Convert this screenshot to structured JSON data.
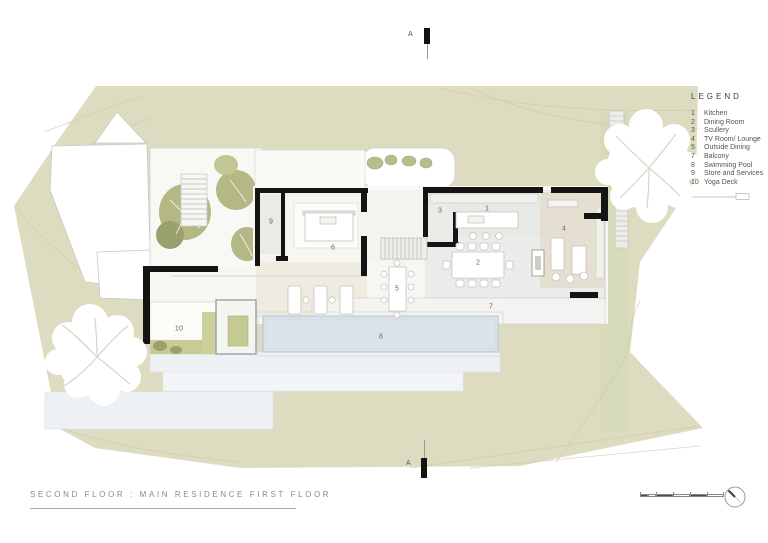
{
  "sheet": {
    "title": "SECOND FLOOR : MAIN RESIDENCE FIRST FLOOR",
    "section_marker_top": "A",
    "section_marker_bottom": "A"
  },
  "legend": {
    "heading": "LEGEND",
    "items": [
      {
        "num": "1",
        "label": "Kitchen"
      },
      {
        "num": "2",
        "label": "Dining Room"
      },
      {
        "num": "3",
        "label": "Scullery"
      },
      {
        "num": "4",
        "label": "TV Room/ Lounge"
      },
      {
        "num": "5",
        "label": "Outside Dining"
      },
      {
        "num": "7",
        "label": "Balcony"
      },
      {
        "num": "8",
        "label": "Swimming Pool"
      },
      {
        "num": "9",
        "label": "Store and Services"
      },
      {
        "num": "10",
        "label": "Yoga Deck"
      }
    ]
  },
  "plan": {
    "room_labels": [
      {
        "num": "1"
      },
      {
        "num": "2"
      },
      {
        "num": "3"
      },
      {
        "num": "4"
      },
      {
        "num": "5"
      },
      {
        "num": "6"
      },
      {
        "num": "7"
      },
      {
        "num": "8"
      },
      {
        "num": "9"
      },
      {
        "num": "10"
      }
    ]
  },
  "colors": {
    "terrain": "#dedcc0",
    "wall": "#141414",
    "pool_water": "#dbe2ea",
    "lounge_floor": "#e5dfd1",
    "planting_green": "#b3b884"
  }
}
